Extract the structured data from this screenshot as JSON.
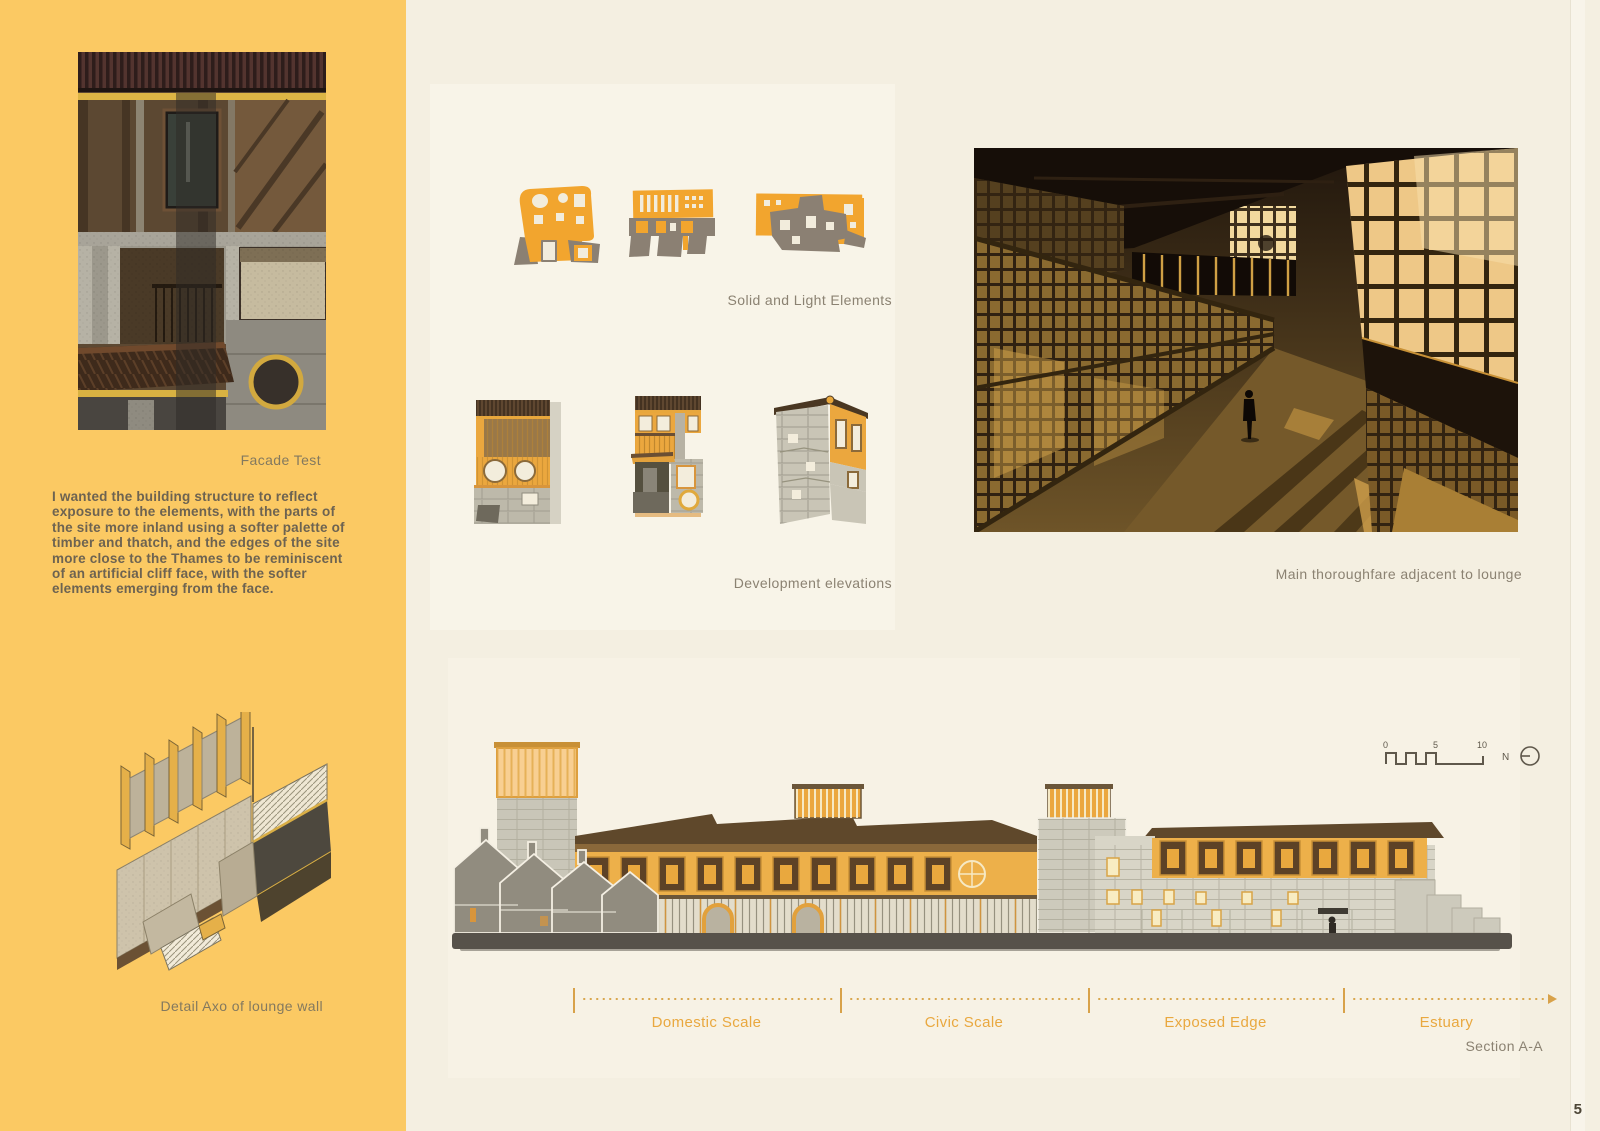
{
  "page": {
    "number": "5"
  },
  "colors": {
    "sidebar_yellow": "#fbc963",
    "canvas_cream": "#f4efe1",
    "accent_orange": "#e9a83f",
    "caption_gray": "#8b8272",
    "ink": "#4c4536",
    "sketch_orange": "#f2a52e",
    "sketch_gray": "#8b8073"
  },
  "sidebar": {
    "facade_caption": "Facade Test",
    "statement": "I wanted the building structure to reflect exposure to the elements, with the parts of the site more inland using a softer palette of timber and thatch, and the edges of the site more close to the Thames to be reminiscent of an artificial cliff face, with the softer elements emerging from the face.",
    "axo_caption": "Detail Axo of lounge wall"
  },
  "main": {
    "sketches_caption": "Solid and Light Elements",
    "elevations_caption": "Development elevations",
    "render_caption": "Main thoroughfare adjacent to lounge",
    "section": {
      "labels": [
        "Domestic Scale",
        "Civic Scale",
        "Exposed Edge",
        "Estuary"
      ],
      "caption": "Section A-A"
    },
    "scale_bar": {
      "zero": "0",
      "five": "5",
      "ten": "10",
      "north": "N"
    }
  }
}
